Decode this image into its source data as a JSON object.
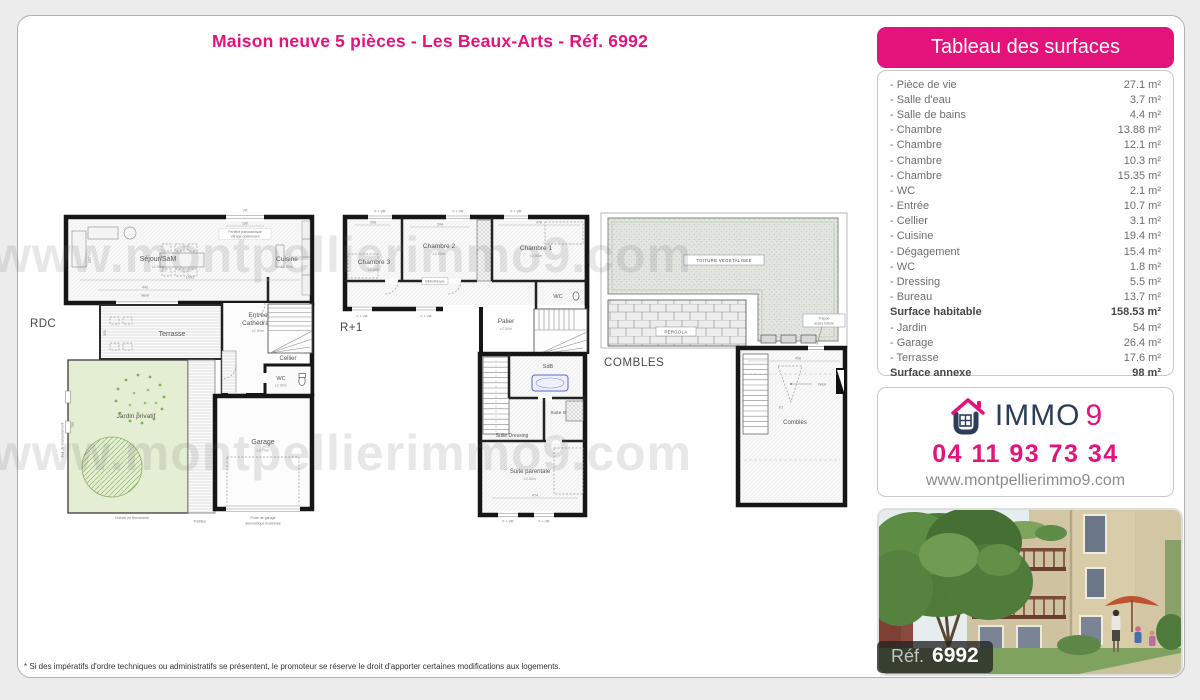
{
  "page": {
    "title": "Maison neuve 5 pièces - Les Beaux-Arts - Réf. 6992",
    "footnote": "* Si des impératifs d'ordre techniques ou administratifs se présentent, le promoteur se réserve le droit d'apporter certaines modifications aux logements.",
    "watermark": "www.montpellierimmo9.com"
  },
  "theme": {
    "pink": "#e4127b",
    "navy": "#2c3d5b"
  },
  "plans": {
    "rdc": {
      "name": "RDC",
      "rooms": {
        "sejour": "Séjour/SàM",
        "cuisine": "Cuisine",
        "terrasse": "Terrasse",
        "entree1": "Entrée",
        "entree2": "Cathédrale",
        "cellier": "Cellier",
        "wc": "WC",
        "jardin": "Jardin privatif",
        "garage": "Garage"
      },
      "ann": {
        "vr": "VR",
        "d180": "180",
        "fen1": "Fenêtre panoramique",
        "fen2": "Vitrage opalescent",
        "d1093": "1093",
        "d440": "440",
        "seuil": "Seuil",
        "d297": "297",
        "bcvr": "BC + VR",
        "d700": "700",
        "brise": "Brise-soleil",
        "d350": "350",
        "h250": "±2.50m",
        "h280": "±2.80m",
        "h270": "±2.70m",
        "h180": "±1.80m",
        "d755": "755",
        "mur": "Mur de soubassement",
        "cloture": "Clôture en ferronnerie",
        "portillon": "Portillon",
        "pg1": "Porte de garage",
        "pg2": "automatique motorisée"
      }
    },
    "r1": {
      "name": "R+1",
      "rooms": {
        "ch3": "Chambre 3",
        "ch2": "Chambre 2",
        "ch1": "Chambre 1",
        "wc": "WC",
        "palier": "Palier",
        "sdb": "SdB",
        "sde": "Suite SdE",
        "dressing": "Suite Dressing",
        "parentale": "Suite parentale"
      },
      "ann": {
        "fvr": "F + VR",
        "d268": "268",
        "d394": "394",
        "d478": "478",
        "biblio": "Bibliothèque",
        "h250": "±2.50m",
        "d474": "474"
      }
    },
    "combles": {
      "name": "COMBLES",
      "rooms": {
        "combles": "Combles"
      },
      "ann": {
        "toiture": "TOITURE VEGETALISEE",
        "pergola": "PERGOLA",
        "trappe1": "Trappe",
        "trappe2": "accès toiture",
        "d456": "456",
        "ft": "FT",
        "velux": "Velux"
      }
    }
  },
  "surfaces": {
    "header": "Tableau des surfaces",
    "rows": [
      {
        "label": "- Pièce de vie",
        "value": "27.1 m²",
        "bold": false
      },
      {
        "label": "- Salle d'eau",
        "value": "3.7 m²",
        "bold": false
      },
      {
        "label": "- Salle de bains",
        "value": "4.4 m²",
        "bold": false
      },
      {
        "label": "- Chambre",
        "value": "13.88 m²",
        "bold": false
      },
      {
        "label": "- Chambre",
        "value": "12.1 m²",
        "bold": false
      },
      {
        "label": "- Chambre",
        "value": "10.3 m²",
        "bold": false
      },
      {
        "label": "- Chambre",
        "value": "15.35 m²",
        "bold": false
      },
      {
        "label": "- WC",
        "value": "2.1 m²",
        "bold": false
      },
      {
        "label": "- Entrée",
        "value": "10.7 m²",
        "bold": false
      },
      {
        "label": "- Cellier",
        "value": "3.1 m²",
        "bold": false
      },
      {
        "label": "- Cuisine",
        "value": "19.4 m²",
        "bold": false
      },
      {
        "label": "- Dégagement",
        "value": "15.4 m²",
        "bold": false
      },
      {
        "label": "- WC",
        "value": "1.8 m²",
        "bold": false
      },
      {
        "label": "- Dressing",
        "value": "5.5 m²",
        "bold": false
      },
      {
        "label": "- Bureau",
        "value": "13.7 m²",
        "bold": false
      },
      {
        "label": "Surface habitable",
        "value": "158.53 m²",
        "bold": true
      },
      {
        "label": "- Jardin",
        "value": "54 m²",
        "bold": false
      },
      {
        "label": "- Garage",
        "value": "26.4 m²",
        "bold": false
      },
      {
        "label": "- Terrasse",
        "value": "17.6 m²",
        "bold": false
      },
      {
        "label": "Surface annexe",
        "value": "98 m²",
        "bold": true
      }
    ]
  },
  "contact": {
    "brand_immo": "IMMO",
    "brand_9": "9",
    "phone": "04 11 93 73 34",
    "website": "www.montpellierimmo9.com"
  },
  "photo": {
    "ref_label": "Réf.",
    "ref_value": "6992"
  }
}
